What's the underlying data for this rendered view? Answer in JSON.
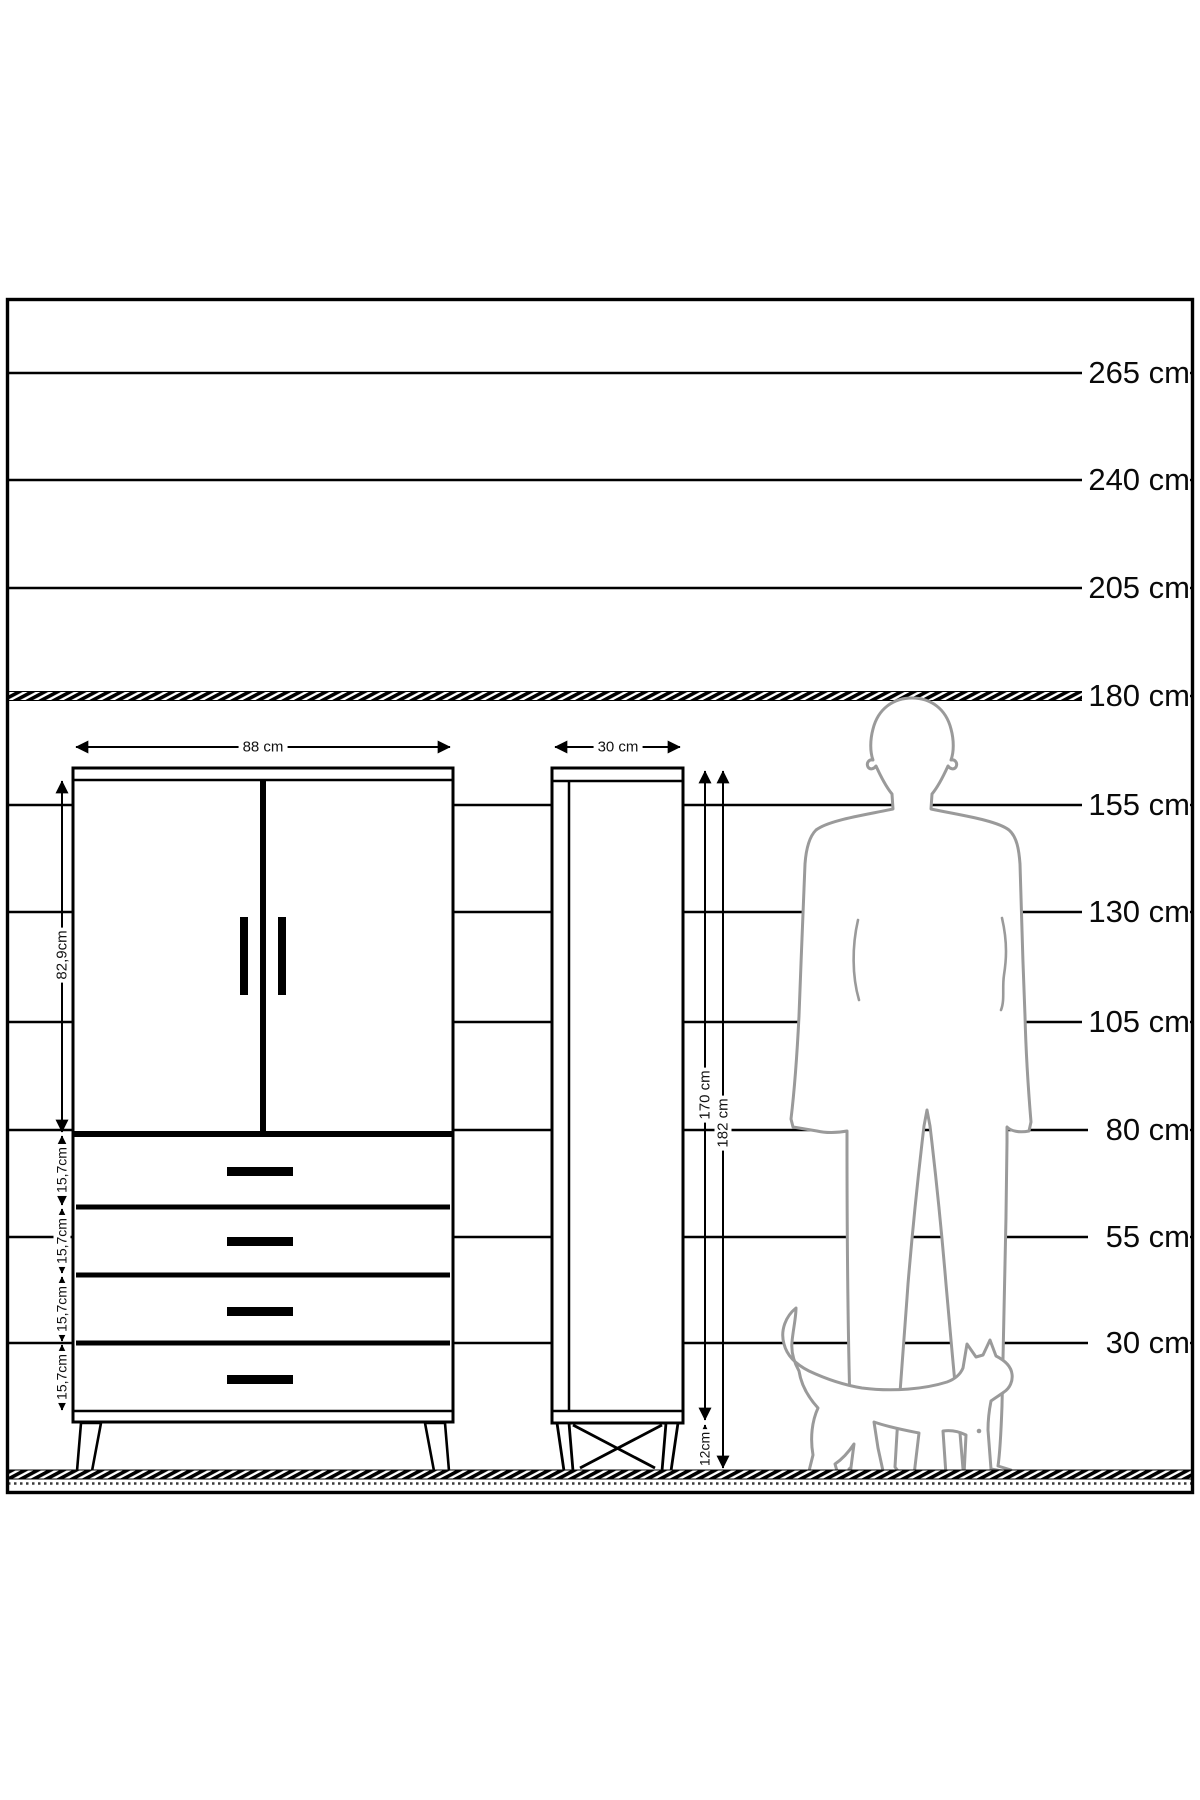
{
  "scale": {
    "labels": [
      "265 cm",
      "240 cm",
      "205 cm",
      "180 cm",
      "155 cm",
      "130 cm",
      "105 cm",
      "80 cm",
      "55 cm",
      "30 cm"
    ]
  },
  "wardrobe": {
    "width_label": "88 cm",
    "upper_section_label": "82,9cm",
    "drawer_labels": [
      "15,7cm",
      "15,7cm",
      "15,7cm",
      "15,7cm"
    ]
  },
  "column": {
    "width_label": "30 cm",
    "body_height_label": "170 cm",
    "total_height_label": "182 cm",
    "legs_label": "12cm"
  },
  "colors": {
    "line": "#000000",
    "silhouette": "#9a9a9a",
    "background": "#ffffff"
  }
}
